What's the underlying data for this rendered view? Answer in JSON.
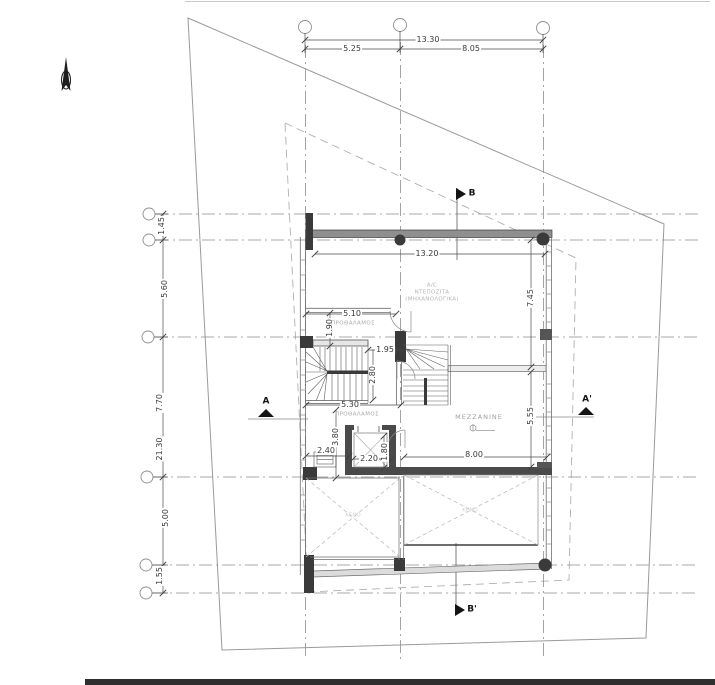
{
  "dims": {
    "top_overall": "13.30",
    "top_seg_a": "5.25",
    "top_seg_b": "8.05",
    "left_seg_1": "1.45",
    "left_seg_2": "5.60",
    "left_seg_3": "7.70",
    "left_overall": "21.30",
    "left_seg_4": "5.00",
    "left_seg_5": "1.55",
    "ac_room_width": "13.20",
    "right_depth": "7.45",
    "vestibule_width": "5.10",
    "vestibule_depth": "1.90",
    "stair_width": "1.95",
    "stair_depth": "2.80",
    "hall_width": "5.30",
    "hall_depth": "3.80",
    "duct_width": "2.40",
    "lift_width": "2.20",
    "lift_depth": "1.80",
    "mezzanine_depth": "5.55",
    "mezzanine_width": "8.00"
  },
  "labels": {
    "ac_line1": "A/C",
    "ac_line2": "ΝΤΕΠΟΖΙΤΑ",
    "ac_line3": "(ΜΗΧΑΝΟΛΟΓΙΚΑ)",
    "vestibule_upper": "ΠΡΟΘΑΛΑΜΟΣ",
    "vestibule_lower": "ΠΡΟΘΑΛΑΜΟΣ",
    "mezzanine": "MEZZANINE",
    "void_left": "ΚΕΝΟ",
    "void_right": "ΚΕΝΟ"
  },
  "sections": {
    "a_start": "A",
    "a_end": "A'",
    "b_start": "B",
    "b_end": "B'"
  },
  "colors": {
    "line_dark": "#3a3a3a",
    "line_mid": "#8e8e8e",
    "line_light": "#b5b5b5",
    "wall_fill": "#8f8f8f",
    "column_fill": "#3a3a3a",
    "room_text": "#aaaaaa",
    "dim_text": "#3a3a3a"
  }
}
